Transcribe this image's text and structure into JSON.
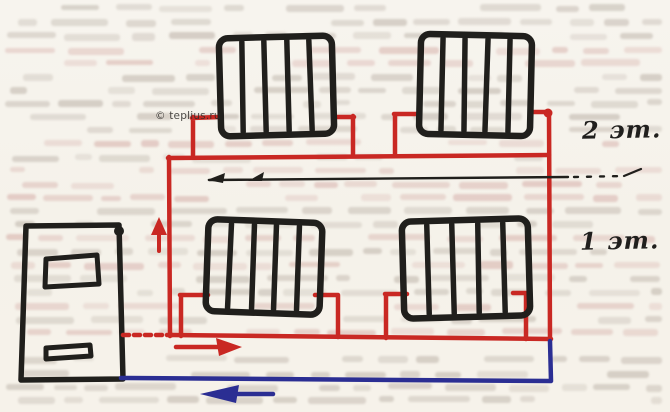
{
  "page": {
    "description": "Scanned book page with hand-drawn two-storey one-pipe heating system diagram",
    "paper_color": "#f5f2ea"
  },
  "watermark": {
    "text": "© teplius.ru"
  },
  "labels": {
    "floor2": "2 эт.",
    "floor1": "1 эт."
  },
  "colors": {
    "supply": "#c92823",
    "return": "#2b2e93",
    "ink": "#201f1c",
    "bleed_gray": "#b1a69b",
    "bleed_pink": "#cfa09a"
  },
  "components": {
    "boiler": "boiler",
    "radiators": [
      "radiator-2f-left",
      "radiator-2f-right",
      "radiator-1f-left",
      "radiator-1f-right"
    ],
    "arrows": [
      "flow-arrow-up",
      "flow-arrow-right",
      "flow-arrow-return-left",
      "ceiling-flow-arrow-left"
    ]
  }
}
